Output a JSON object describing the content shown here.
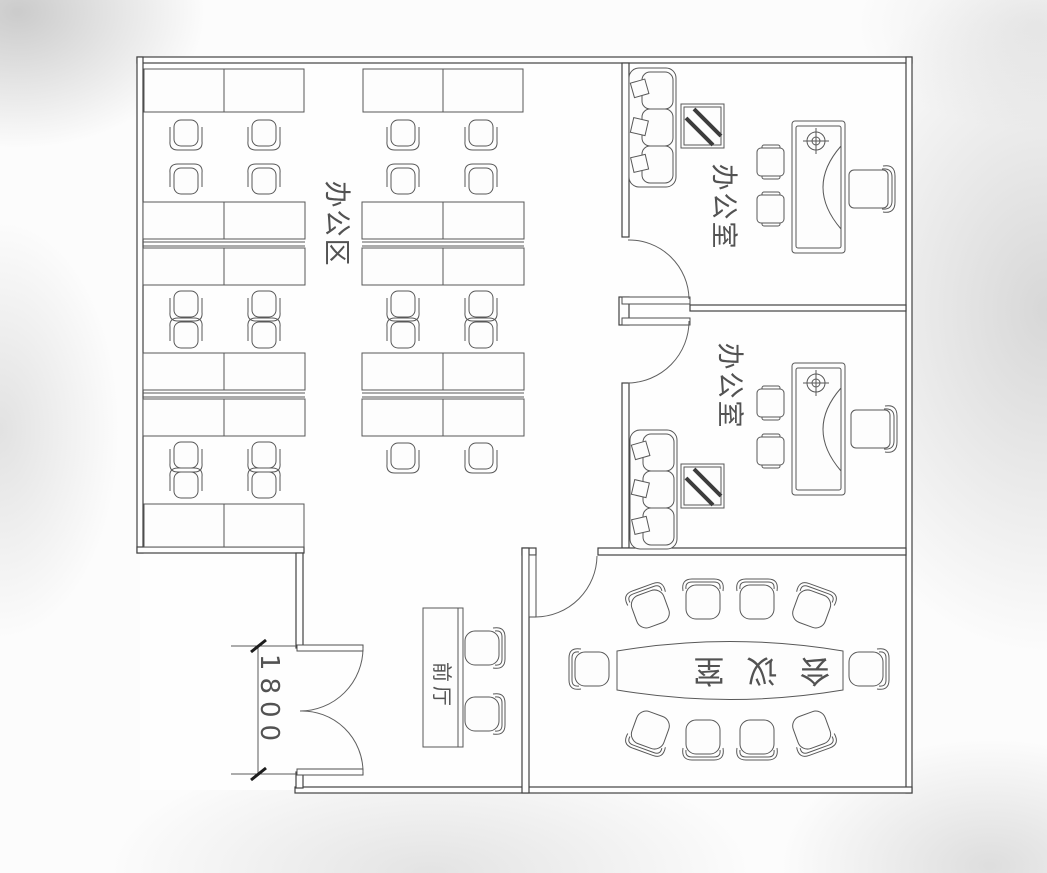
{
  "plan": {
    "type": "office floor plan drawing",
    "rooms": {
      "office_area": {
        "label": "办公区"
      },
      "office_top": {
        "label": "办公室"
      },
      "office_mid": {
        "label": "办公室"
      },
      "meeting_room": {
        "label": "会议室"
      },
      "front_hall": {
        "label": "前厅"
      }
    },
    "dimensions": {
      "entrance_width": "1800"
    },
    "colors": {
      "wall_line": "#424242",
      "furniture_line": "#585858",
      "label_text": "#525252",
      "paper": "#fcfcfc",
      "edge_shade": "#bdbdbd"
    }
  }
}
